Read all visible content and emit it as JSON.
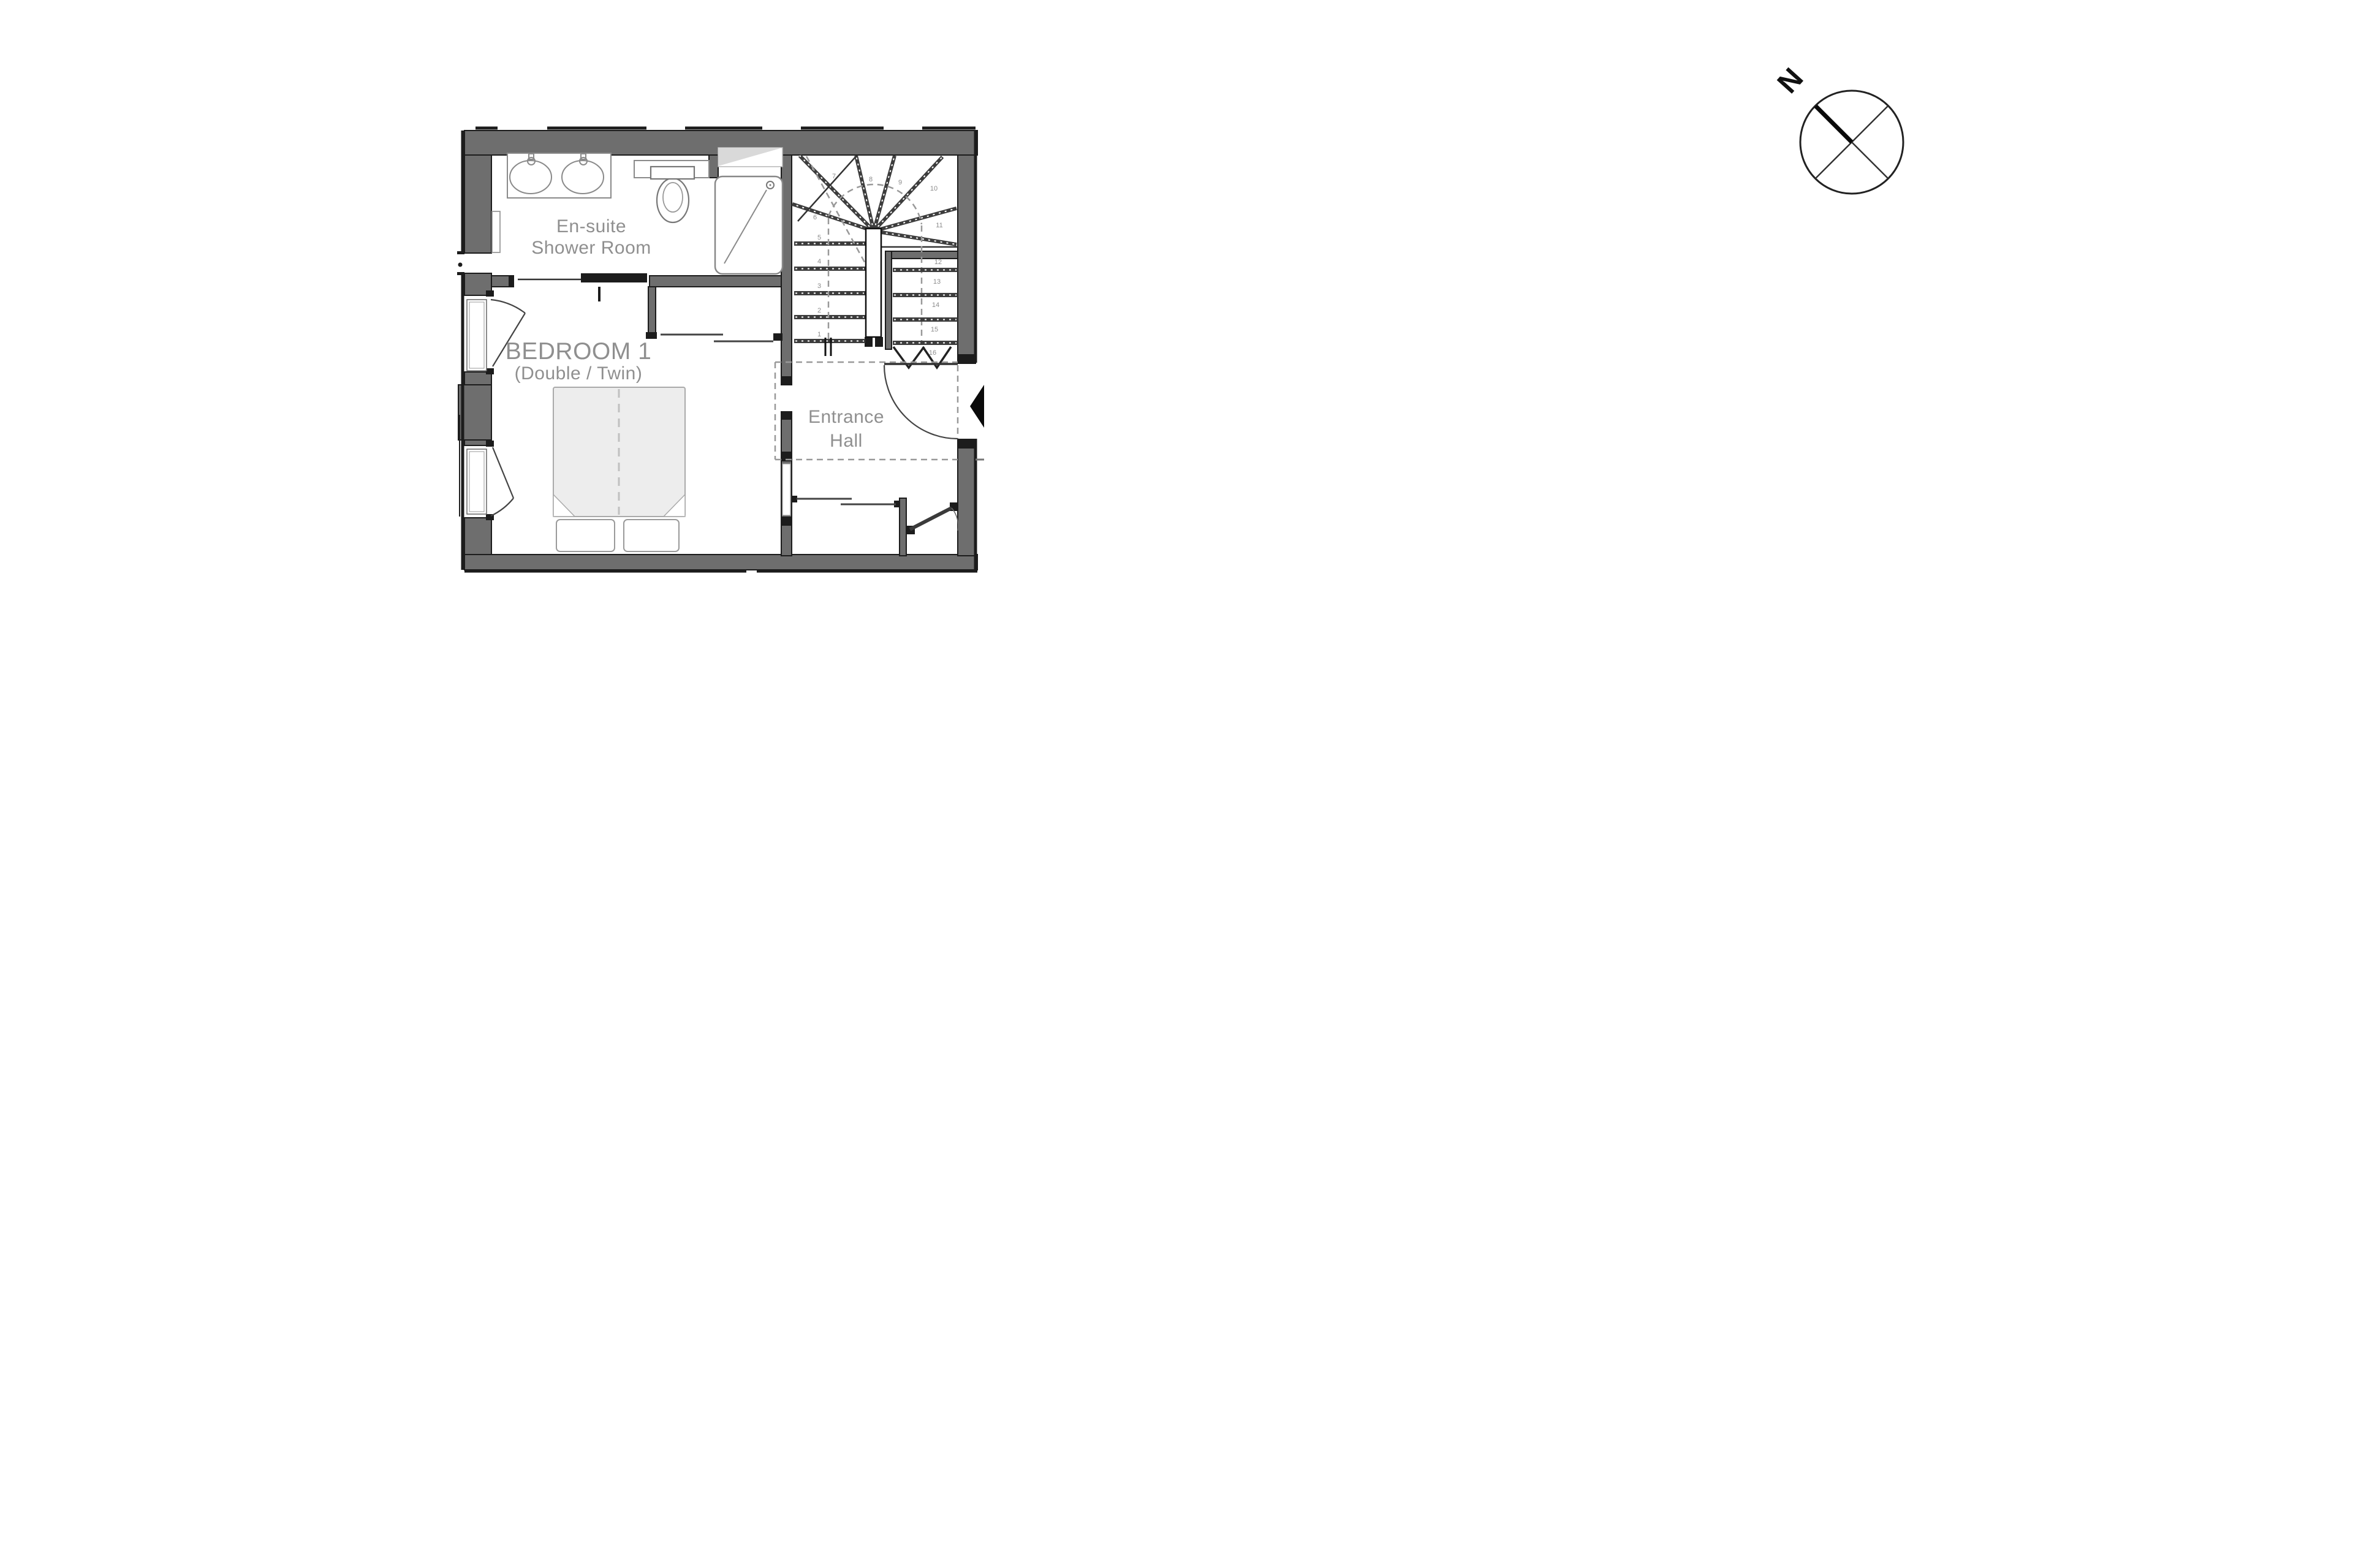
{
  "floor_plan": {
    "rooms": {
      "ensuite": {
        "line1": "En-suite",
        "line2": "Shower Room"
      },
      "bedroom": {
        "line1": "BEDROOM 1",
        "line2": "(Double / Twin)"
      },
      "hall": {
        "line1": "Entrance",
        "line2": "Hall"
      }
    },
    "stairs": {
      "steps": [
        "1",
        "2",
        "3",
        "4",
        "5",
        "6",
        "7",
        "8",
        "9",
        "10",
        "11",
        "12",
        "13",
        "14",
        "15",
        "16"
      ]
    },
    "colors": {
      "wall_fill": "#6e6e6e",
      "wall_edge": "#1c1c1c",
      "label": "#8f8f8f",
      "stair": "#3d3d3d",
      "dash": "#999999",
      "fixture": "#8a8a8a",
      "bed_fill": "#ededed"
    }
  },
  "compass": {
    "north": "N"
  }
}
